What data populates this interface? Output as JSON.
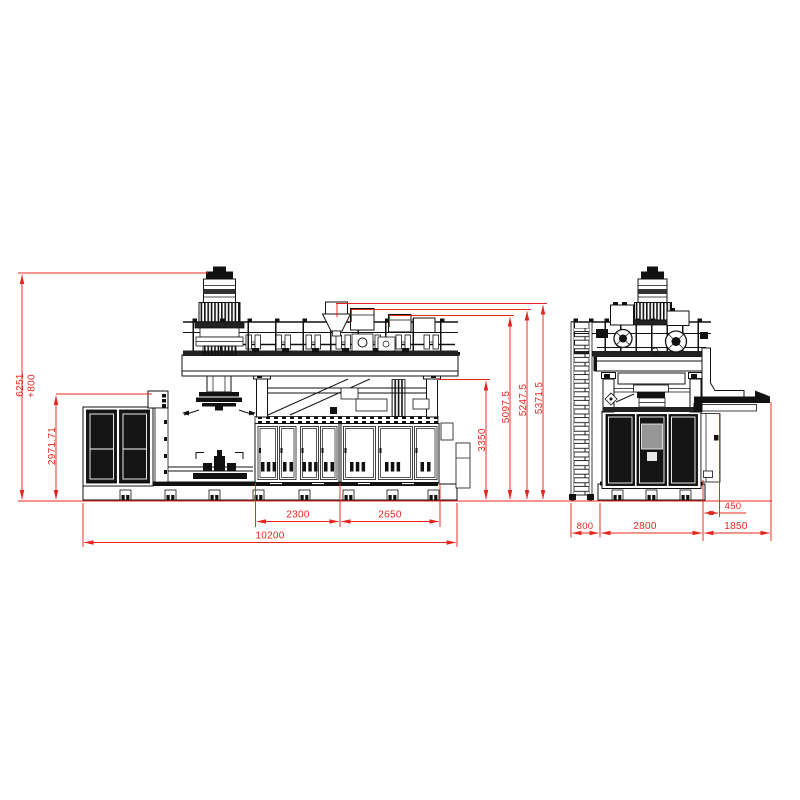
{
  "drawing": {
    "type": "technical-two-view-machine-drawing",
    "front_view": {
      "dims": {
        "total_height": "6251",
        "total_height_extra": "+800",
        "cabinet_height": "2971.71",
        "frame_height": "3350",
        "head_height_1": "5097.5",
        "head_height_2": "5247.5",
        "head_height_3": "5371.5",
        "bay_width_1": "2300",
        "bay_width_2": "2650",
        "overall_length": "10200"
      }
    },
    "side_view": {
      "dims": {
        "ladder_width": "800",
        "body_width": "2800",
        "discharge_width": "1850",
        "discharge_offset": "450"
      }
    },
    "colors": {
      "dimension_red": "#e8251d",
      "linework_black": "#111111",
      "panel_dark": "#151515",
      "background": "#ffffff"
    }
  }
}
